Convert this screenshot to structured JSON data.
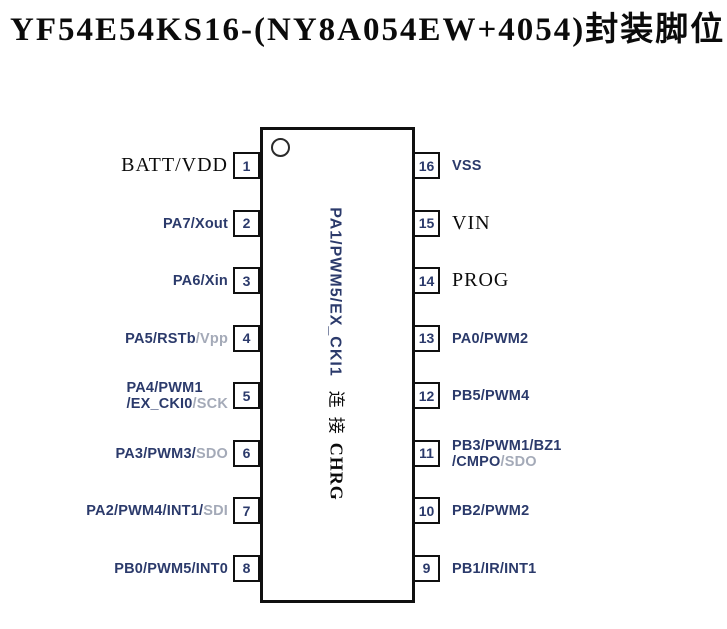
{
  "title": "YF54E54KS16-(NY8A054EW+4054)封装脚位图",
  "colors": {
    "background": "#ffffff",
    "navy": "#2b3a6b",
    "gray": "#a4aab8",
    "black": "#0b0b0b",
    "chip_border": "#101010"
  },
  "chip": {
    "pin1_indicator": "circle-icon",
    "inner_label_segments": [
      {
        "text": "PA1/PWM5/EX_CKI1",
        "style": "v-sans-navy"
      },
      {
        "text": "连接",
        "style": "v-cjk-black"
      },
      {
        "text": "CHRG",
        "style": "v-serif-black"
      }
    ]
  },
  "pins_left": [
    {
      "number": "1",
      "lines": [
        [
          {
            "text": "BATT/VDD",
            "style": "seg-serif-black"
          }
        ]
      ]
    },
    {
      "number": "2",
      "lines": [
        [
          {
            "text": "PA7/Xout",
            "style": "seg-sans-navy"
          }
        ]
      ]
    },
    {
      "number": "3",
      "lines": [
        [
          {
            "text": "PA6/Xin",
            "style": "seg-sans-navy"
          }
        ]
      ]
    },
    {
      "number": "4",
      "lines": [
        [
          {
            "text": "PA5/RSTb",
            "style": "seg-sans-navy"
          },
          {
            "text": "/Vpp",
            "style": "seg-sans-gray"
          }
        ]
      ]
    },
    {
      "number": "5",
      "lines": [
        [
          {
            "text": "PA4/PWM1",
            "style": "seg-sans-navy"
          }
        ],
        [
          {
            "text": "/EX_CKI0",
            "style": "seg-sans-navy"
          },
          {
            "text": "/SCK",
            "style": "seg-sans-gray"
          }
        ]
      ]
    },
    {
      "number": "6",
      "lines": [
        [
          {
            "text": "PA3/PWM3/",
            "style": "seg-sans-navy"
          },
          {
            "text": "SDO",
            "style": "seg-sans-gray"
          }
        ]
      ]
    },
    {
      "number": "7",
      "lines": [
        [
          {
            "text": "PA2/PWM4/INT1/",
            "style": "seg-sans-navy"
          },
          {
            "text": "SDI",
            "style": "seg-sans-gray"
          }
        ]
      ]
    },
    {
      "number": "8",
      "lines": [
        [
          {
            "text": "PB0/PWM5/INT0",
            "style": "seg-sans-navy"
          }
        ]
      ]
    }
  ],
  "pins_right": [
    {
      "number": "16",
      "lines": [
        [
          {
            "text": "VSS",
            "style": "seg-sans-navy"
          }
        ]
      ]
    },
    {
      "number": "15",
      "lines": [
        [
          {
            "text": "VIN",
            "style": "seg-serif-black"
          }
        ]
      ]
    },
    {
      "number": "14",
      "lines": [
        [
          {
            "text": "PROG",
            "style": "seg-serif-black"
          }
        ]
      ]
    },
    {
      "number": "13",
      "lines": [
        [
          {
            "text": "PA0/PWM2",
            "style": "seg-sans-navy"
          }
        ]
      ]
    },
    {
      "number": "12",
      "lines": [
        [
          {
            "text": "PB5/PWM4",
            "style": "seg-sans-navy"
          }
        ]
      ]
    },
    {
      "number": "11",
      "lines": [
        [
          {
            "text": "PB3/PWM1/BZ1",
            "style": "seg-sans-navy"
          }
        ],
        [
          {
            "text": "/CMPO",
            "style": "seg-sans-navy"
          },
          {
            "text": "/SDO",
            "style": "seg-sans-gray"
          }
        ]
      ]
    },
    {
      "number": "10",
      "lines": [
        [
          {
            "text": "PB2/PWM2",
            "style": "seg-sans-navy"
          }
        ]
      ]
    },
    {
      "number": "9",
      "lines": [
        [
          {
            "text": "PB1/IR/INT1",
            "style": "seg-sans-navy"
          }
        ]
      ]
    }
  ]
}
